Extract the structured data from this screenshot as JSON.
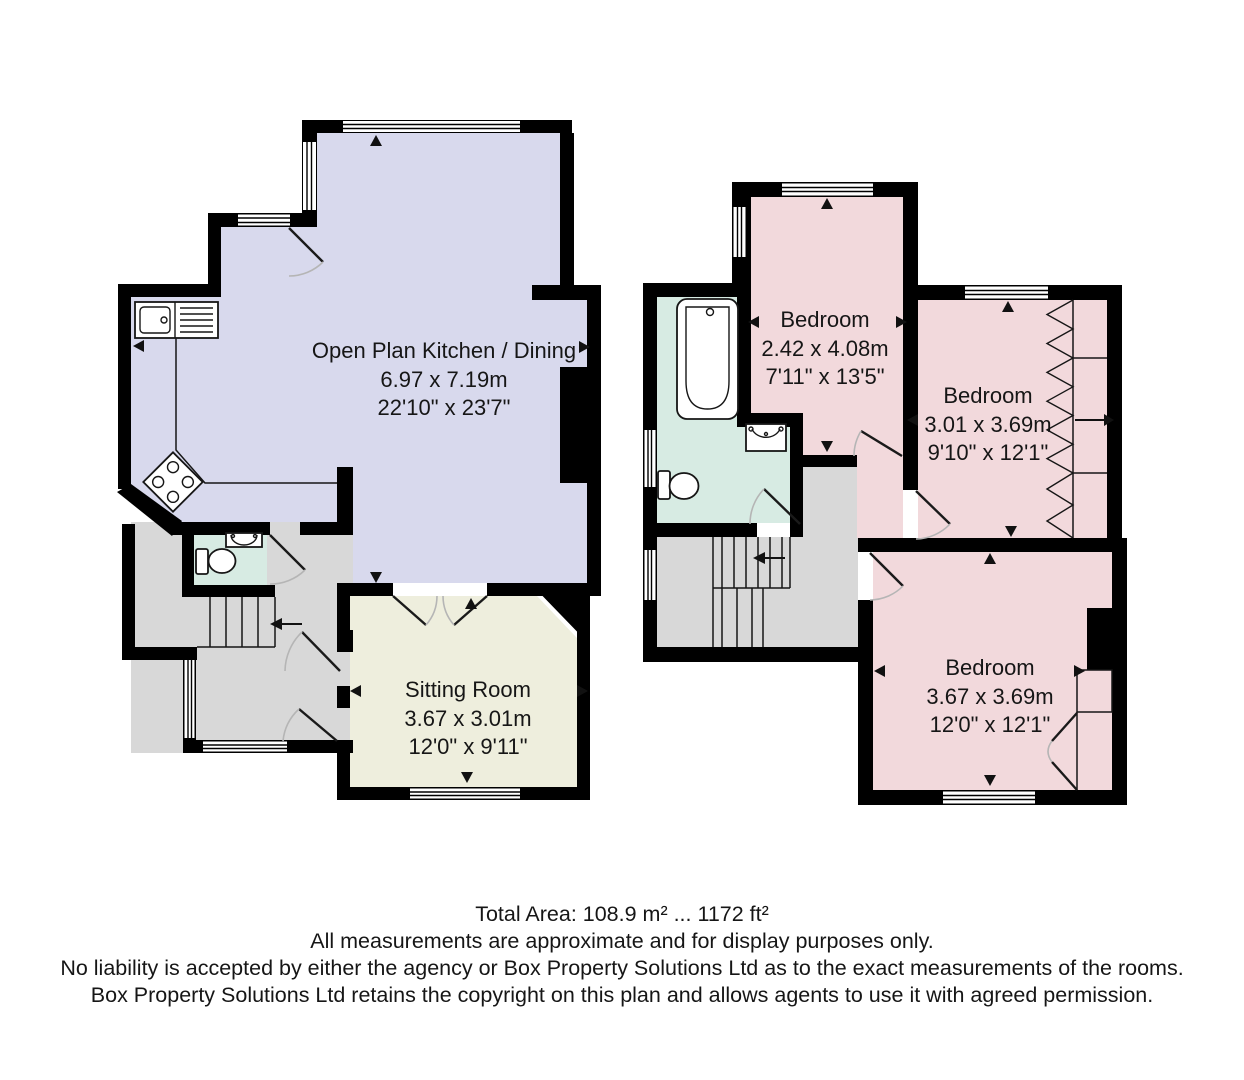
{
  "rooms": {
    "kitchen": {
      "name": "Open Plan Kitchen / Dining",
      "metric": "6.97 x 7.19m",
      "imperial": "22'10\" x 23'7\""
    },
    "sitting": {
      "name": "Sitting Room",
      "metric": "3.67 x 3.01m",
      "imperial": "12'0\" x 9'11\""
    },
    "bedroom1": {
      "name": "Bedroom",
      "metric": "2.42 x 4.08m",
      "imperial": "7'11\" x 13'5\""
    },
    "bedroom2": {
      "name": "Bedroom",
      "metric": "3.01 x 3.69m",
      "imperial": "9'10\" x 12'1\""
    },
    "bedroom3": {
      "name": "Bedroom",
      "metric": "3.67 x 3.69m",
      "imperial": "12'0\" x 12'1\""
    }
  },
  "footer": {
    "total_area": "Total Area: 108.9 m² ... 1172 ft²",
    "line2": "All measurements are approximate and for display purposes only.",
    "line3": "No liability is accepted by either the agency or Box Property Solutions Ltd as to the exact measurements of the rooms.",
    "line4": "Box Property Solutions Ltd retains the copyright on this plan and allows agents to use it with agreed permission."
  },
  "colors": {
    "kitchen": "#d8d9ed",
    "sitting": "#eeeedd",
    "bedroom": "#f2d9dc",
    "bathroom": "#d7ebe3",
    "hall": "#d8d8d8",
    "wall": "#000000"
  }
}
